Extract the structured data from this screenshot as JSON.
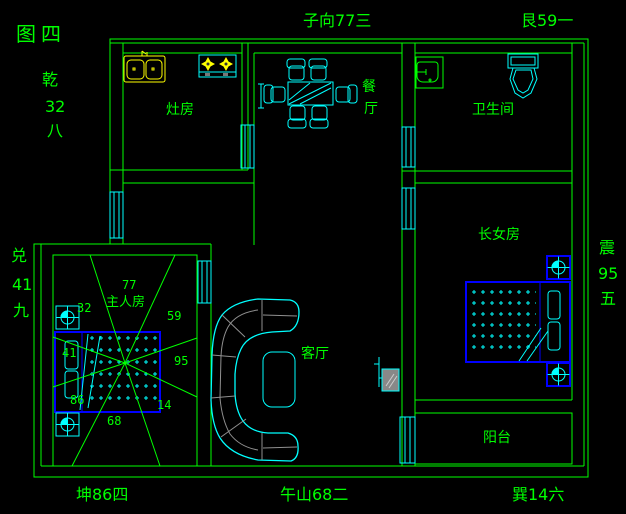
{
  "figure": {
    "label": "图四"
  },
  "perimeter": {
    "nw1": "乾",
    "nw2": "32",
    "nw3": "八",
    "n": "子向77三",
    "ne": "艮59一",
    "w1": "兑",
    "w2": "41",
    "w3": "九",
    "e1": "震",
    "e2": "95",
    "e3": "五",
    "sw": "坤86四",
    "s": "午山68二",
    "se": "巽14六"
  },
  "rooms": {
    "kitchen": "灶房",
    "dining1": "餐",
    "dining2": "厅",
    "bathroom": "卫生间",
    "daughter": "长女房",
    "master": "主人房",
    "living": "客厅",
    "balcony": "阳台"
  },
  "stars": {
    "n": "77",
    "ne": "59",
    "e": "95",
    "se": "14",
    "s": "68",
    "sw": "86",
    "w": "41",
    "nw": "32"
  },
  "colors": {
    "background": "#000000",
    "wall": "#00ff00",
    "furniture": "#00ffff",
    "fixture_yellow": "#ffff00",
    "bed_blue": "#0000ff",
    "sofa_seam_gray": "#909090"
  }
}
